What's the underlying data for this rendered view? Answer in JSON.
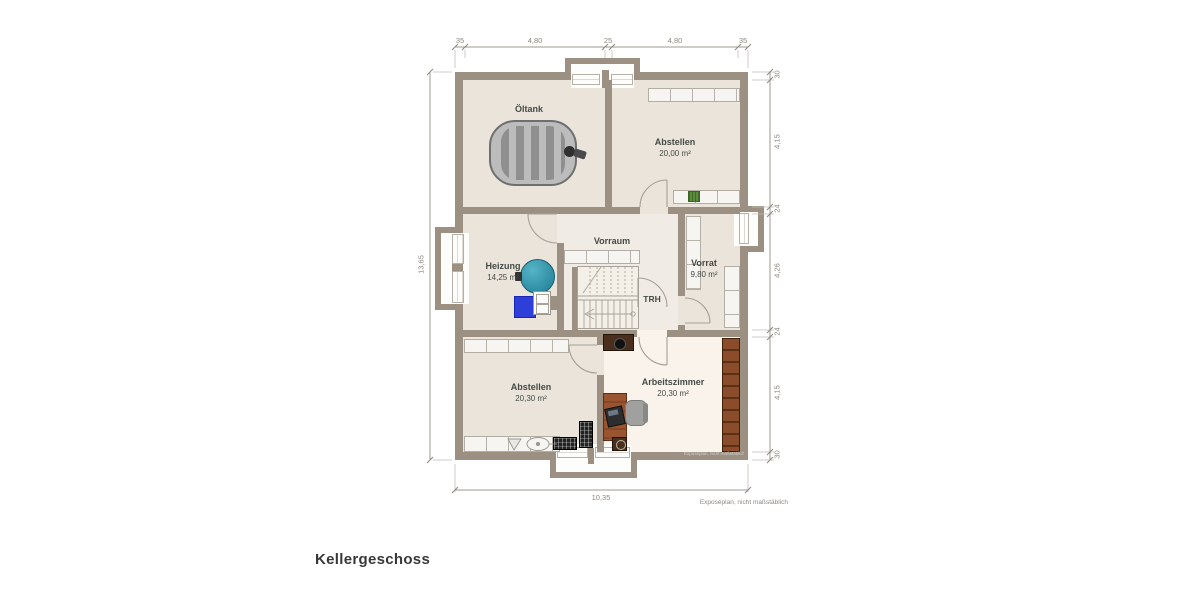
{
  "title": "Kellergeschoss",
  "footer_note": "Exposéplan, nicht maßstäblich",
  "rooms": {
    "oeltank": {
      "name": "Öltank"
    },
    "abstellen_top": {
      "name": "Abstellen",
      "area": "20,00 m²"
    },
    "vorraum": {
      "name": "Vorraum"
    },
    "heizung": {
      "name": "Heizung",
      "area": "14,25 m²"
    },
    "vorrat": {
      "name": "Vorrat",
      "area": "9,80 m²"
    },
    "treppenhaus": {
      "name": "TRH"
    },
    "abstellen_bottom": {
      "name": "Abstellen",
      "area": "20,30 m²"
    },
    "arbeitszimmer": {
      "name": "Arbeitszimmer",
      "area": "20,30 m²"
    }
  },
  "dimensions": {
    "top": [
      "35",
      "4,80",
      "25",
      "4,80",
      "35"
    ],
    "right": [
      "30",
      "4,15",
      "24",
      "4,26",
      "24",
      "4,15",
      "30"
    ],
    "left": [
      "13,65"
    ],
    "bottom": [
      "10,35"
    ]
  },
  "colors": {
    "wall": "#9c9083",
    "floor": "#eae4db",
    "hall_floor": "#f0ebe4",
    "work_floor": "#f9f3eb",
    "boiler": "#2d8aa3",
    "heater": "#2f3fd6",
    "wood": "#96522e",
    "dark_wood": "#4a2f1f"
  }
}
